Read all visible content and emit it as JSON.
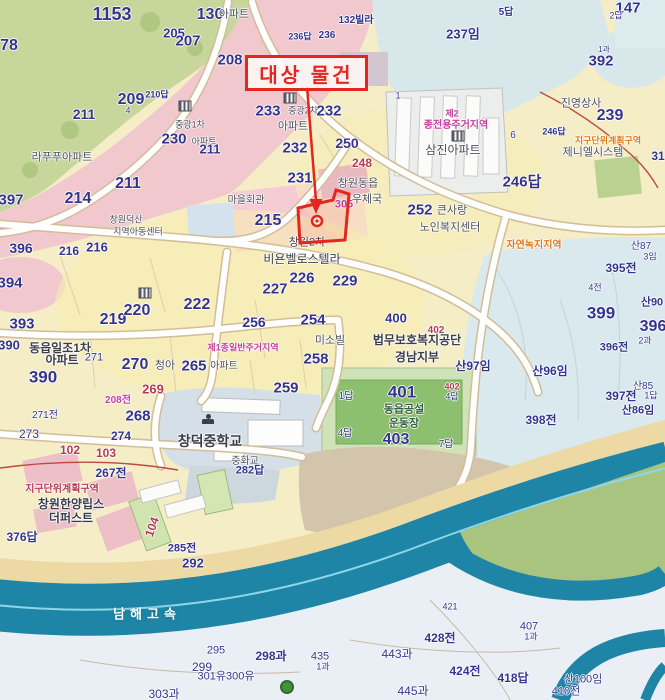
{
  "map": {
    "annotation": {
      "label": "대상 물건"
    },
    "palette": {
      "nv": "#34348e",
      "gy": "#4b4f5e",
      "dk": "#3a3d4a",
      "mg": "#c63d9d",
      "or": "#e0791c",
      "rd": "#b23b52",
      "wt": "#ffffff",
      "gn": "#35603a",
      "accent": "#e42520",
      "teal": "#1f85a6"
    },
    "labels": [
      [
        112,
        14,
        "1153",
        "nv",
        18
      ],
      [
        9,
        46,
        "78",
        "nv",
        16
      ],
      [
        210,
        15,
        "130",
        "nv",
        16
      ],
      [
        234,
        15,
        "아파트",
        "gy",
        11,
        400
      ],
      [
        300,
        37,
        "236답",
        "nv",
        9
      ],
      [
        327,
        36,
        "236",
        "nv",
        10
      ],
      [
        356,
        21,
        "132빌라",
        "nv",
        10
      ],
      [
        174,
        33,
        "205",
        "nv",
        13
      ],
      [
        188,
        41,
        "207",
        "nv",
        15
      ],
      [
        230,
        60,
        "208",
        "nv",
        15
      ],
      [
        131,
        100,
        "209",
        "nv",
        16
      ],
      [
        157,
        95,
        "210답",
        "nv",
        9
      ],
      [
        128,
        111,
        "4",
        "nv",
        9,
        400
      ],
      [
        506,
        13,
        "5답",
        "nv",
        10
      ],
      [
        628,
        8,
        "147",
        "nv",
        15
      ],
      [
        616,
        16,
        "2답",
        "nv",
        9,
        400
      ],
      [
        463,
        34,
        "237임",
        "nv",
        13
      ],
      [
        601,
        61,
        "392",
        "nv",
        15
      ],
      [
        604,
        50,
        "1과",
        "nv",
        8,
        400
      ],
      [
        610,
        116,
        "239",
        "nv",
        16
      ],
      [
        581,
        104,
        "진영상사",
        "gy",
        11,
        400
      ],
      [
        608,
        141,
        "지구단위계획구역",
        "or",
        9
      ],
      [
        593,
        153,
        "제니엘시스템",
        "gy",
        11,
        400
      ],
      [
        658,
        156,
        "31",
        "nv",
        12
      ],
      [
        452,
        114,
        "제2",
        "mg",
        9
      ],
      [
        456,
        126,
        "종전용주거지역",
        "mg",
        10
      ],
      [
        453,
        150,
        "삼진아파트",
        "gy",
        12,
        400
      ],
      [
        398,
        96,
        "1",
        "nv",
        9,
        400
      ],
      [
        513,
        136,
        "6",
        "nv",
        10,
        400
      ],
      [
        554,
        132,
        "246답",
        "nv",
        9
      ],
      [
        522,
        182,
        "246답",
        "nv",
        15
      ],
      [
        534,
        246,
        "자연녹지지역",
        "or",
        10
      ],
      [
        268,
        111,
        "233",
        "nv",
        15
      ],
      [
        303,
        111,
        "중광2차",
        "gy",
        9,
        400
      ],
      [
        329,
        111,
        "232",
        "nv",
        15
      ],
      [
        293,
        127,
        "아파트",
        "gy",
        11,
        400
      ],
      [
        190,
        125,
        "중광1차",
        "gy",
        9,
        400
      ],
      [
        174,
        139,
        "230",
        "nv",
        15
      ],
      [
        204,
        142,
        "아파트",
        "gy",
        9,
        400
      ],
      [
        295,
        148,
        "232",
        "nv",
        15
      ],
      [
        347,
        143,
        "250",
        "nv",
        14
      ],
      [
        362,
        163,
        "248",
        "rd",
        12
      ],
      [
        300,
        178,
        "231",
        "nv",
        15
      ],
      [
        358,
        184,
        "창원동읍",
        "gy",
        11,
        400
      ],
      [
        367,
        200,
        "우체국",
        "gy",
        11,
        400
      ],
      [
        246,
        201,
        "마을회관",
        "gy",
        10,
        400
      ],
      [
        268,
        221,
        "215",
        "nv",
        16
      ],
      [
        344,
        205,
        "305",
        "mg",
        11
      ],
      [
        307,
        243,
        "창원2차",
        "dk",
        11,
        400
      ],
      [
        302,
        259,
        "비욘벨로스텔라",
        "dk",
        12,
        400
      ],
      [
        302,
        278,
        "226",
        "nv",
        15
      ],
      [
        275,
        289,
        "227",
        "nv",
        15
      ],
      [
        345,
        281,
        "229",
        "nv",
        15
      ],
      [
        420,
        210,
        "252",
        "nv",
        15
      ],
      [
        452,
        211,
        "큰사랑",
        "gy",
        11,
        400
      ],
      [
        450,
        228,
        "노인복지센터",
        "gy",
        11,
        400
      ],
      [
        84,
        114,
        "211",
        "nv",
        14
      ],
      [
        62,
        158,
        "라푸푸아파트",
        "gy",
        11,
        400
      ],
      [
        210,
        149,
        "211",
        "nv",
        13
      ],
      [
        128,
        184,
        "211",
        "nv",
        16
      ],
      [
        78,
        199,
        "214",
        "nv",
        16
      ],
      [
        11,
        200,
        "397",
        "nv",
        15
      ],
      [
        126,
        220,
        "창원덕산",
        "gy",
        9,
        400
      ],
      [
        138,
        232,
        "지역아동센터",
        "gy",
        9,
        400
      ],
      [
        21,
        248,
        "396",
        "nv",
        14
      ],
      [
        69,
        251,
        "216",
        "nv",
        12
      ],
      [
        97,
        247,
        "216",
        "nv",
        13
      ],
      [
        10,
        283,
        "394",
        "nv",
        15
      ],
      [
        22,
        324,
        "393",
        "nv",
        15
      ],
      [
        9,
        345,
        "390",
        "nv",
        13
      ],
      [
        60,
        348,
        "동읍일조1차",
        "dk",
        12
      ],
      [
        62,
        360,
        "아파트",
        "dk",
        12
      ],
      [
        94,
        358,
        "271",
        "nv",
        11,
        400
      ],
      [
        43,
        377,
        "390",
        "nv",
        17
      ],
      [
        113,
        320,
        "219",
        "nv",
        16
      ],
      [
        137,
        311,
        "220",
        "nv",
        16
      ],
      [
        197,
        305,
        "222",
        "nv",
        16
      ],
      [
        254,
        322,
        "256",
        "nv",
        14
      ],
      [
        313,
        320,
        "254",
        "nv",
        15
      ],
      [
        243,
        348,
        "제1종일반주거지역",
        "mg",
        9
      ],
      [
        330,
        341,
        "미소빌",
        "gy",
        11,
        400
      ],
      [
        316,
        359,
        "258",
        "nv",
        15
      ],
      [
        135,
        365,
        "270",
        "nv",
        16
      ],
      [
        165,
        366,
        "청아",
        "gy",
        11,
        400
      ],
      [
        194,
        366,
        "265",
        "nv",
        15
      ],
      [
        224,
        367,
        "아파트",
        "gy",
        10,
        400
      ],
      [
        153,
        389,
        "269",
        "rd",
        13
      ],
      [
        286,
        388,
        "259",
        "nv",
        15
      ],
      [
        118,
        401,
        "208전",
        "mg",
        10
      ],
      [
        45,
        416,
        "271전",
        "nv",
        10,
        400
      ],
      [
        29,
        434,
        "273",
        "nv",
        12,
        400
      ],
      [
        70,
        450,
        "102",
        "rd",
        12
      ],
      [
        121,
        436,
        "274",
        "nv",
        12
      ],
      [
        106,
        453,
        "103",
        "rd",
        12
      ],
      [
        138,
        416,
        "268",
        "nv",
        15
      ],
      [
        210,
        441,
        "창덕중학교",
        "dk",
        14
      ],
      [
        245,
        462,
        "중화교",
        "gy",
        10,
        400
      ],
      [
        396,
        318,
        "400",
        "nv",
        13
      ],
      [
        436,
        331,
        "402",
        "rd",
        10
      ],
      [
        417,
        340,
        "법무보호복지공단",
        "dk",
        12
      ],
      [
        417,
        357,
        "경남지부",
        "dk",
        12
      ],
      [
        473,
        366,
        "산97임",
        "nv",
        12
      ],
      [
        550,
        371,
        "산96임",
        "nv",
        12
      ],
      [
        402,
        392,
        "401",
        "nv",
        17
      ],
      [
        346,
        397,
        "1답",
        "nv",
        10,
        400
      ],
      [
        452,
        387,
        "402",
        "rd",
        9
      ],
      [
        452,
        397,
        "4답",
        "nv",
        9,
        400
      ],
      [
        404,
        410,
        "동읍공설",
        "gn",
        11
      ],
      [
        404,
        424,
        "운동장",
        "gn",
        11
      ],
      [
        345,
        434,
        "4답",
        "nv",
        10,
        400
      ],
      [
        396,
        440,
        "403",
        "nv",
        16
      ],
      [
        446,
        445,
        "7답",
        "nv",
        10,
        400
      ],
      [
        621,
        268,
        "395전",
        "nv",
        12
      ],
      [
        641,
        247,
        "산87",
        "nv",
        10,
        400
      ],
      [
        650,
        257,
        "3임",
        "nv",
        9,
        400
      ],
      [
        595,
        288,
        "4전",
        "nv",
        9,
        400
      ],
      [
        601,
        313,
        "399",
        "nv",
        17
      ],
      [
        652,
        303,
        "산90",
        "nv",
        11
      ],
      [
        653,
        327,
        "396",
        "nv",
        16
      ],
      [
        645,
        341,
        "2과",
        "nv",
        9,
        400
      ],
      [
        614,
        348,
        "396전",
        "nv",
        11
      ],
      [
        643,
        387,
        "산85",
        "nv",
        10,
        400
      ],
      [
        651,
        396,
        "1답",
        "nv",
        9,
        400
      ],
      [
        621,
        396,
        "397전",
        "nv",
        12
      ],
      [
        638,
        411,
        "산86임",
        "nv",
        11
      ],
      [
        541,
        420,
        "398전",
        "nv",
        12
      ],
      [
        250,
        471,
        "282답",
        "nv",
        11
      ],
      [
        111,
        473,
        "267전",
        "nv",
        12
      ],
      [
        62,
        490,
        "지구단위계획구역",
        "rd",
        10
      ],
      [
        71,
        504,
        "창원한양립스",
        "dk",
        12
      ],
      [
        71,
        518,
        "더퍼스트",
        "dk",
        12
      ],
      [
        22,
        537,
        "376답",
        "nv",
        12
      ],
      [
        152,
        527,
        "104",
        "rd",
        12,
        700,
        -70
      ],
      [
        182,
        549,
        "285전",
        "nv",
        11
      ],
      [
        193,
        563,
        "292",
        "nv",
        13
      ],
      [
        147,
        614,
        "남해고속",
        "wt",
        13,
        700,
        0,
        5
      ],
      [
        216,
        651,
        "295",
        "nv",
        11,
        400
      ],
      [
        202,
        667,
        "299",
        "nv",
        12,
        400
      ],
      [
        226,
        677,
        "301유300유",
        "nv",
        11,
        400
      ],
      [
        271,
        656,
        "298과",
        "nv",
        12
      ],
      [
        320,
        657,
        "435",
        "nv",
        11,
        400
      ],
      [
        323,
        667,
        "1과",
        "nv",
        9,
        400
      ],
      [
        164,
        694,
        "303과",
        "nv",
        12,
        400
      ],
      [
        450,
        607,
        "421",
        "nv",
        9,
        400
      ],
      [
        440,
        638,
        "428전",
        "nv",
        12
      ],
      [
        397,
        654,
        "443과",
        "nv",
        12,
        400
      ],
      [
        465,
        671,
        "424전",
        "nv",
        12
      ],
      [
        513,
        678,
        "418답",
        "nv",
        12
      ],
      [
        413,
        691,
        "445과",
        "nv",
        12,
        400
      ],
      [
        529,
        627,
        "407",
        "nv",
        11,
        400
      ],
      [
        531,
        637,
        "1과",
        "nv",
        9,
        400
      ],
      [
        583,
        680,
        "산100임",
        "nv",
        11,
        400
      ],
      [
        566,
        692,
        "410전",
        "nv",
        11,
        400
      ]
    ],
    "icons": [
      {
        "x": 185,
        "y": 106,
        "type": "building"
      },
      {
        "x": 290,
        "y": 98,
        "type": "building"
      },
      {
        "x": 458,
        "y": 136,
        "type": "building"
      },
      {
        "x": 145,
        "y": 293,
        "type": "building"
      },
      {
        "x": 208,
        "y": 419,
        "type": "school"
      },
      {
        "x": 287,
        "y": 687,
        "type": "tree"
      }
    ],
    "target_box": {
      "x": 245,
      "y": 55,
      "w": 117,
      "h": 30
    }
  }
}
